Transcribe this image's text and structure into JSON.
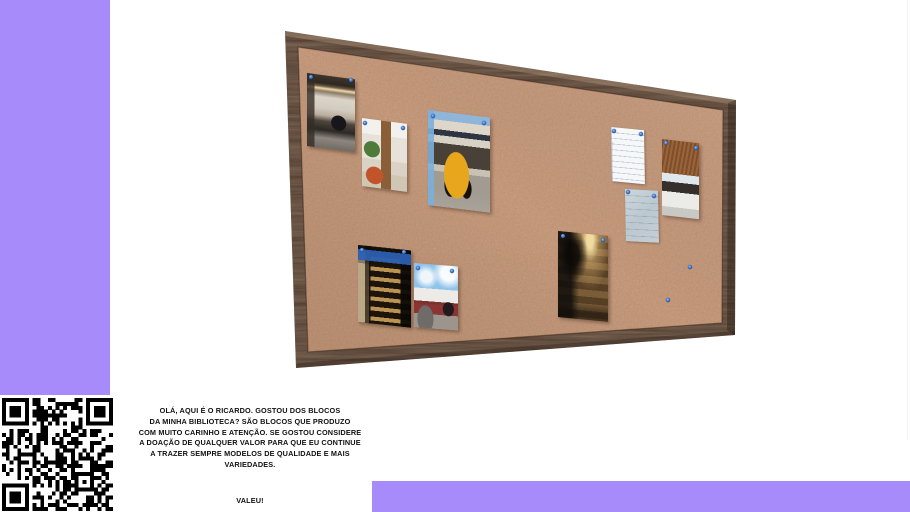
{
  "message": {
    "lines": [
      "OLÁ, AQUI É O RICARDO. GOSTOU DOS BLOCOS",
      "DA MINHA BIBLIOTECA? SÃO BLOCOS QUE PRODUZO",
      "COM MUITO CARINHO E ATENÇÃO. SE GOSTOU CONSIDERE",
      "A DOAÇÃO DE QUALQUER VALOR PARA QUE EU CONTINUE",
      "A TRAZER SEMPRE MODELOS DE QUALIDADE E MAIS",
      "VARIEDADES."
    ],
    "closing": "VALEU!"
  },
  "colors": {
    "accent_purple": "#a78bfa",
    "cork_surface": "#c69476",
    "frame_wood": "#4e3a2d",
    "pin_blue": "#3a76d2"
  },
  "photos": [
    {
      "name": "home-office-interior-photo"
    },
    {
      "name": "living-room-interior-photo"
    },
    {
      "name": "yellow-vintage-truck-photo"
    },
    {
      "name": "white-document-sheet"
    },
    {
      "name": "kitchen-interior-photo"
    },
    {
      "name": "gray-sketch-sheet"
    },
    {
      "name": "dark-warehouse-interior-photo"
    },
    {
      "name": "vending-machine-night-photo"
    },
    {
      "name": "street-facade-with-car-photo"
    }
  ]
}
